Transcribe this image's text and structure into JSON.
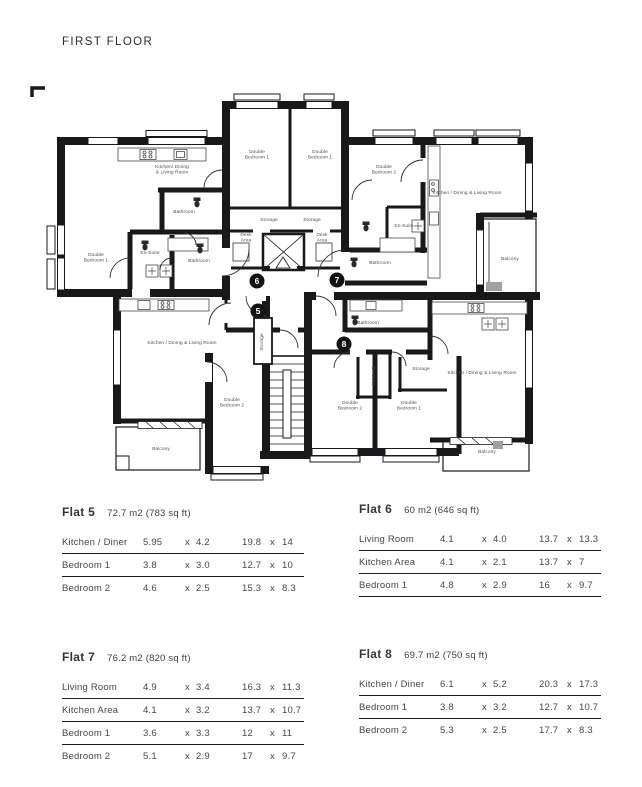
{
  "title": "FIRST FLOOR",
  "table_separator": "x",
  "colors": {
    "wall": "#19191b",
    "room_label": "#4f4f55",
    "marker_fill": "#111111",
    "rule_line": "#1c1c1e"
  },
  "floorplan": {
    "room_labels": [
      {
        "lines": [
          "Kitchen/ Dining",
          "& Living Room"
        ],
        "x": 172,
        "y": 168
      },
      {
        "lines": [
          "Bathroom"
        ],
        "x": 184,
        "y": 213
      },
      {
        "lines": [
          "Double",
          "Bedroom 1"
        ],
        "x": 96,
        "y": 256
      },
      {
        "lines": [
          "En-Suite"
        ],
        "x": 150,
        "y": 254
      },
      {
        "lines": [
          "Bathroom"
        ],
        "x": 199,
        "y": 262
      },
      {
        "lines": [
          "Double",
          "Bedroom 1"
        ],
        "x": 257,
        "y": 153
      },
      {
        "lines": [
          "Double",
          "Bedroom 1"
        ],
        "x": 320,
        "y": 153
      },
      {
        "lines": [
          "Storage"
        ],
        "x": 269,
        "y": 221
      },
      {
        "lines": [
          "Storage"
        ],
        "x": 312,
        "y": 221
      },
      {
        "lines": [
          "Desk",
          "Area"
        ],
        "x": 246,
        "y": 236
      },
      {
        "lines": [
          "Desk",
          "Area"
        ],
        "x": 322,
        "y": 236
      },
      {
        "lines": [
          "Double",
          "Bedroom 2"
        ],
        "x": 384,
        "y": 168
      },
      {
        "lines": [
          "En-Suite"
        ],
        "x": 404,
        "y": 227
      },
      {
        "lines": [
          "Bathroom"
        ],
        "x": 380,
        "y": 264
      },
      {
        "lines": [
          "Kitchen / Dining & Living Room"
        ],
        "x": 467,
        "y": 194
      },
      {
        "lines": [
          "Balcony"
        ],
        "x": 510,
        "y": 260
      },
      {
        "lines": [
          "Kitchen / Dining & Living Room"
        ],
        "x": 182,
        "y": 344
      },
      {
        "lines": [
          "Storage"
        ],
        "x": 263,
        "y": 342,
        "rotate": -90
      },
      {
        "lines": [
          "Double",
          "Bedroom 2"
        ],
        "x": 232,
        "y": 401
      },
      {
        "lines": [
          "Balcony"
        ],
        "x": 161,
        "y": 450
      },
      {
        "lines": [
          "Bathroom"
        ],
        "x": 368,
        "y": 324
      },
      {
        "lines": [
          "Double",
          "Bedroom 2"
        ],
        "x": 350,
        "y": 404
      },
      {
        "lines": [
          "Double",
          "Bedroom 1"
        ],
        "x": 409,
        "y": 404
      },
      {
        "lines": [
          "Storage"
        ],
        "x": 421,
        "y": 370
      },
      {
        "lines": [
          "En-Suite"
        ],
        "x": 372,
        "y": 376,
        "rotate": 90
      },
      {
        "lines": [
          "Kitchen / Dining  & Living Room"
        ],
        "x": 482,
        "y": 374
      },
      {
        "lines": [
          "Balcony"
        ],
        "x": 487,
        "y": 453
      }
    ],
    "flat_markers": [
      {
        "number": "5",
        "x": 258,
        "y": 311
      },
      {
        "number": "6",
        "x": 257,
        "y": 281
      },
      {
        "number": "7",
        "x": 337,
        "y": 280
      },
      {
        "number": "8",
        "x": 344,
        "y": 344
      }
    ]
  },
  "flats": [
    {
      "name": "Flat 5",
      "area": "72.7 m2 (783 sq ft)",
      "bottom_border": false,
      "rows": [
        {
          "room": "Kitchen / Diner",
          "m": [
            "5.95",
            "4.2"
          ],
          "ft": [
            "19.8",
            "14"
          ]
        },
        {
          "room": "Bedroom 1",
          "m": [
            "3.8",
            "3.0"
          ],
          "ft": [
            "12.7",
            "10"
          ]
        },
        {
          "room": "Bedroom 2",
          "m": [
            "4.6",
            "2.5"
          ],
          "ft": [
            "15.3",
            "8.3"
          ]
        }
      ]
    },
    {
      "name": "Flat 6",
      "area": "60 m2  (646 sq ft)",
      "bottom_border": true,
      "rows": [
        {
          "room": "Living Room",
          "m": [
            "4.1",
            "4.0"
          ],
          "ft": [
            "13.7",
            "13.3"
          ]
        },
        {
          "room": "Kitchen Area",
          "m": [
            "4.1",
            "2.1"
          ],
          "ft": [
            "13.7",
            "7"
          ]
        },
        {
          "room": "Bedroom 1",
          "m": [
            "4.8",
            "2.9"
          ],
          "ft": [
            "16",
            "9.7"
          ]
        }
      ]
    },
    {
      "name": "Flat 7",
      "area": "76.2 m2 (820 sq ft)",
      "bottom_border": false,
      "rows": [
        {
          "room": "Living Room",
          "m": [
            "4.9",
            "3.4"
          ],
          "ft": [
            "16.3",
            "11.3"
          ]
        },
        {
          "room": "Kitchen Area",
          "m": [
            "4.1",
            "3.2"
          ],
          "ft": [
            "13.7",
            "10.7"
          ]
        },
        {
          "room": "Bedroom 1",
          "m": [
            "3.6",
            "3.3"
          ],
          "ft": [
            "12",
            "11"
          ]
        },
        {
          "room": "Bedroom 2",
          "m": [
            "5.1",
            "2.9"
          ],
          "ft": [
            "17",
            "9.7"
          ]
        }
      ]
    },
    {
      "name": "Flat 8",
      "area": "69.7 m2 (750 sq ft)",
      "bottom_border": false,
      "rows": [
        {
          "room": "Kitchen / Diner",
          "m": [
            "6.1",
            "5.2"
          ],
          "ft": [
            "20.3",
            "17.3"
          ]
        },
        {
          "room": "Bedroom 1",
          "m": [
            "3.8",
            "3.2"
          ],
          "ft": [
            "12.7",
            "10.7"
          ]
        },
        {
          "room": "Bedroom 2",
          "m": [
            "5.3",
            "2.5"
          ],
          "ft": [
            "17.7",
            "8.3"
          ]
        }
      ]
    }
  ]
}
